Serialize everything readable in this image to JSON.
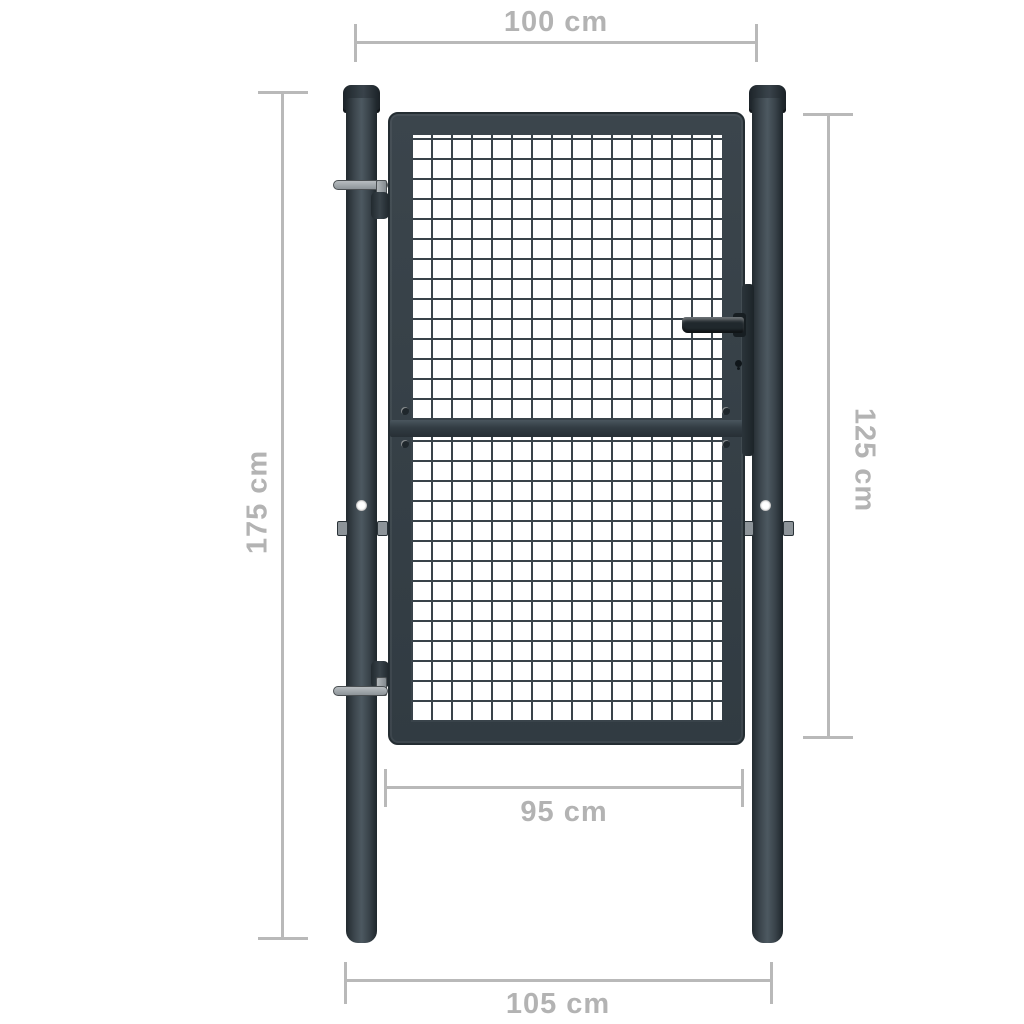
{
  "meta": {
    "title": "Mesh garden gate with posts - dimension diagram"
  },
  "dimensions": {
    "opening_width": {
      "label": "100 cm",
      "orientation": "horizontal",
      "position": "top"
    },
    "post_height": {
      "label": "175 cm",
      "orientation": "vertical",
      "position": "left"
    },
    "gate_leaf_height": {
      "label": "125 cm",
      "orientation": "vertical",
      "position": "right"
    },
    "gate_leaf_width": {
      "label": "95 cm",
      "orientation": "horizontal",
      "position": "bottom-inner"
    },
    "overall_width": {
      "label": "105 cm",
      "orientation": "horizontal",
      "position": "bottom-outer"
    }
  },
  "colors": {
    "background": "#ffffff",
    "frame_metal": "#364047",
    "frame_edge_dark": "#242d32",
    "post_highlight": "#4d5961",
    "mesh_wire": "#39434a",
    "dimension_line": "#b9b9b9",
    "dimension_text": "#b3b3b3",
    "hinge_metal": "#9aa1a5",
    "post_hole": "#ffffff"
  }
}
